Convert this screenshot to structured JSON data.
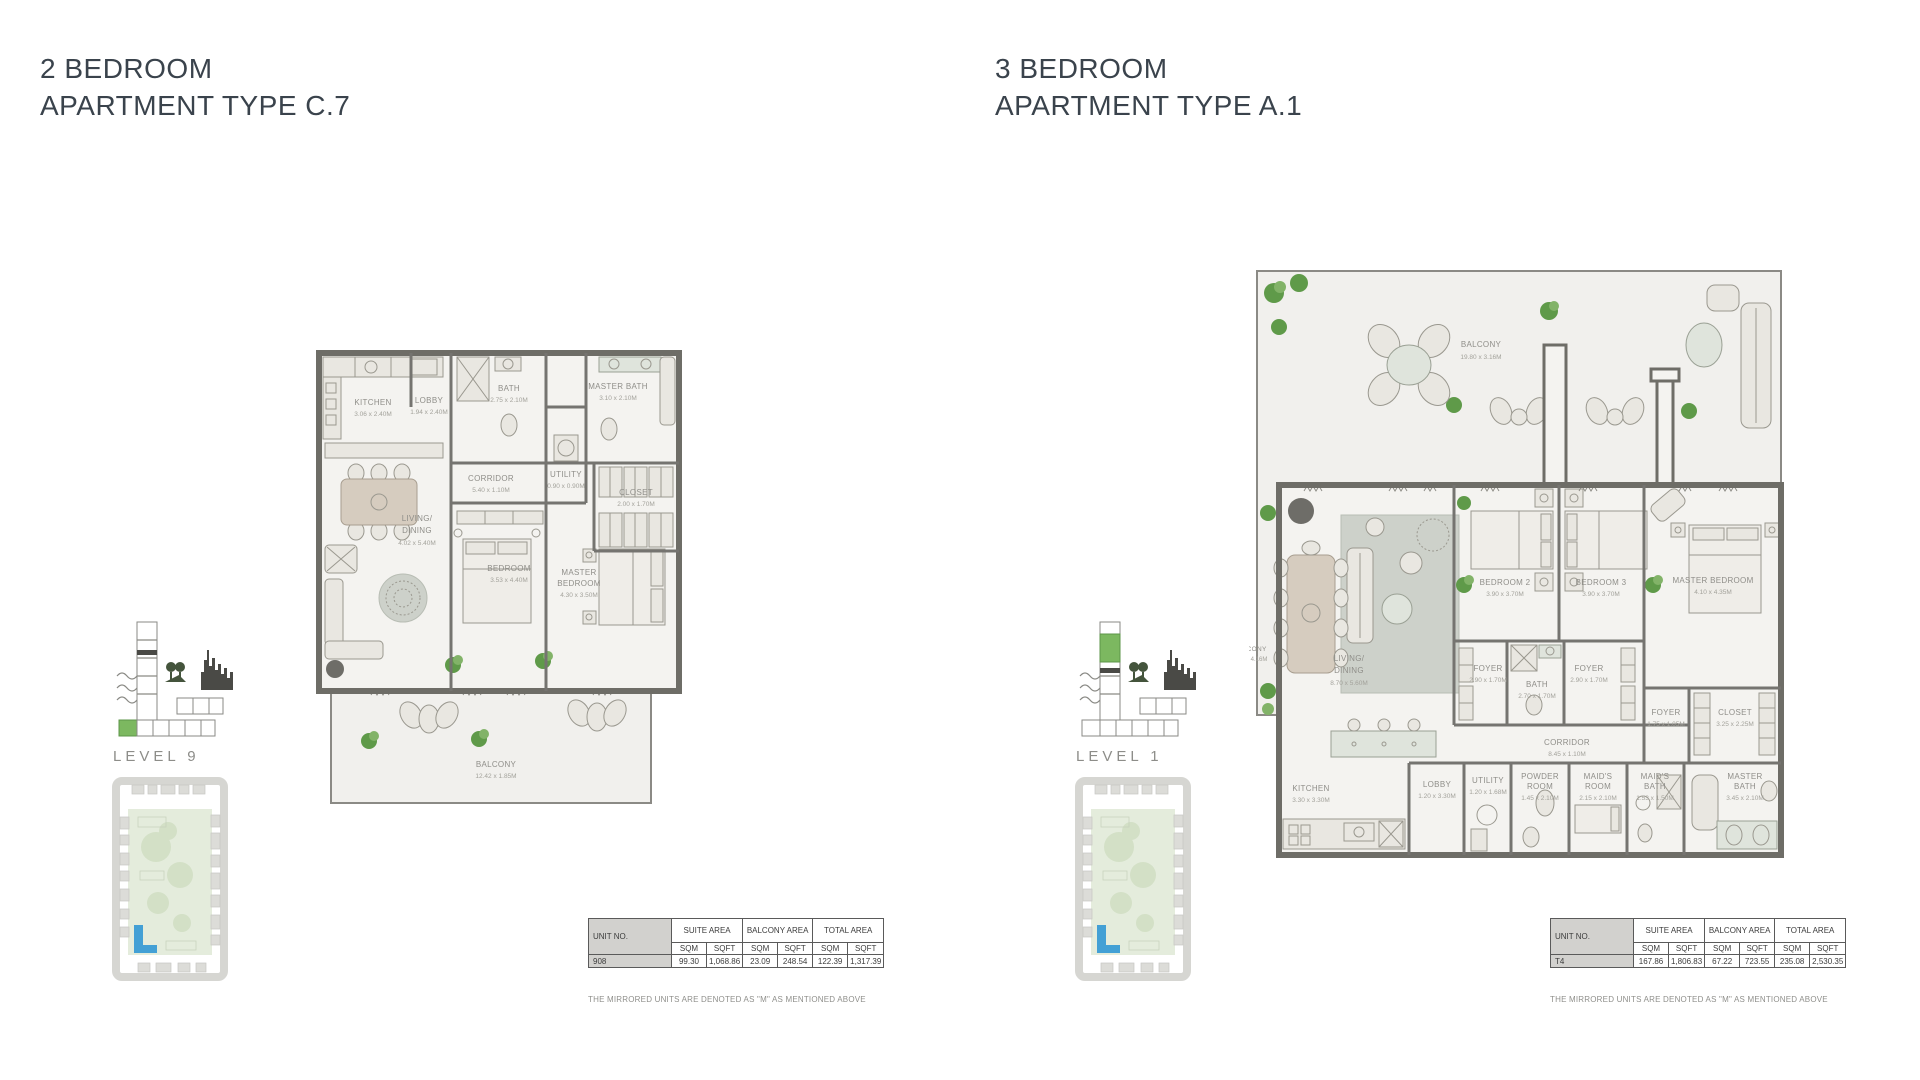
{
  "colors": {
    "accent_green": "#7cb860",
    "map_blue": "#43a0d5",
    "wall": "#6e6d67",
    "title_text": "#3a434c"
  },
  "labels": {
    "unit_no": "UNIT NO.",
    "suite_area": "SUITE AREA",
    "balcony_area": "BALCONY AREA",
    "total_area": "TOTAL AREA",
    "sqm": "SQM",
    "sqft": "SQFT",
    "note": "THE MIRRORED UNITS ARE DENOTED AS \"M\" AS MENTIONED ABOVE"
  },
  "left": {
    "title_line1": "2 BEDROOM",
    "title_line2": "APARTMENT TYPE C.7",
    "level": "LEVEL 9",
    "plan": {
      "kitchen": {
        "name": "KITCHEN",
        "dims": "3.06 x 2.40M"
      },
      "lobby": {
        "name": "LOBBY",
        "dims": "1.94 x 2.40M"
      },
      "bath": {
        "name": "BATH",
        "dims": "2.75 x 2.10M"
      },
      "master_bath": {
        "name": "MASTER BATH",
        "dims": "3.10 x 2.10M"
      },
      "corridor": {
        "name": "CORRIDOR",
        "dims": "5.40 x 1.10M"
      },
      "utility": {
        "name": "UTILITY",
        "dims": "0.90 x 0.90M"
      },
      "closet": {
        "name": "CLOSET",
        "dims": "2.00 x 1.70M"
      },
      "living": {
        "name": "LIVING/",
        "name2": "DINING",
        "dims": "4.02 x 5.40M"
      },
      "bedroom": {
        "name": "BEDROOM",
        "dims": "3.53 x 4.40M"
      },
      "master_bedroom": {
        "name": "MASTER",
        "name2": "BEDROOM",
        "dims": "4.30 x 3.50M"
      },
      "balcony": {
        "name": "BALCONY",
        "dims": "12.42 x 1.85M"
      }
    },
    "table": {
      "unit": "908",
      "suite_sqm": "99.30",
      "suite_sqft": "1,068.86",
      "balcony_sqm": "23.09",
      "balcony_sqft": "248.54",
      "total_sqm": "122.39",
      "total_sqft": "1,317.39"
    }
  },
  "right": {
    "title_line1": "3 BEDROOM",
    "title_line2": "APARTMENT TYPE A.1",
    "level": "LEVEL 1",
    "plan": {
      "balcony_top": {
        "name": "BALCONY",
        "dims": "19.80 x 3.16M"
      },
      "balcony_side": {
        "name": "BALCONY",
        "dims": "1.25 x 4.16M"
      },
      "living": {
        "name": "LIVING/",
        "name2": "DINING",
        "dims": "8.70 x 5.60M"
      },
      "bedroom2": {
        "name": "BEDROOM 2",
        "dims": "3.90 x 3.70M"
      },
      "bedroom3": {
        "name": "BEDROOM 3",
        "dims": "3.90 x 3.70M"
      },
      "master_bedroom": {
        "name": "MASTER BEDROOM",
        "dims": "4.10 x 4.35M"
      },
      "foyer1": {
        "name": "FOYER",
        "dims": "2.90 x 1.70M"
      },
      "bath": {
        "name": "BATH",
        "dims": "2.70 x 1.70M"
      },
      "foyer2": {
        "name": "FOYER",
        "dims": "2.90 x 1.70M"
      },
      "foyer3": {
        "name": "FOYER",
        "dims": "1.75 x 1.05M"
      },
      "closet": {
        "name": "CLOSET",
        "dims": "3.25 x 2.25M"
      },
      "corridor": {
        "name": "CORRIDOR",
        "dims": "8.45 x 1.10M"
      },
      "kitchen": {
        "name": "KITCHEN",
        "dims": "3.30 x 3.30M"
      },
      "lobby": {
        "name": "LOBBY",
        "dims": "1.20 x 3.30M"
      },
      "utility": {
        "name": "UTILITY",
        "dims": "1.20 x 1.68M"
      },
      "powder": {
        "name": "POWDER",
        "name2": "ROOM",
        "dims": "1.45 x 2.10M"
      },
      "maids_room": {
        "name": "MAID'S",
        "name2": "ROOM",
        "dims": "2.15 x 2.10M"
      },
      "maids_bath": {
        "name": "MAID'S",
        "name2": "BATH",
        "dims": "1.53 x 1.50M"
      },
      "master_bath": {
        "name": "MASTER",
        "name2": "BATH",
        "dims": "3.45 x 2.10M"
      }
    },
    "table": {
      "unit": "T4",
      "suite_sqm": "167.86",
      "suite_sqft": "1,806.83",
      "balcony_sqm": "67.22",
      "balcony_sqft": "723.55",
      "total_sqm": "235.08",
      "total_sqft": "2,530.35"
    }
  }
}
